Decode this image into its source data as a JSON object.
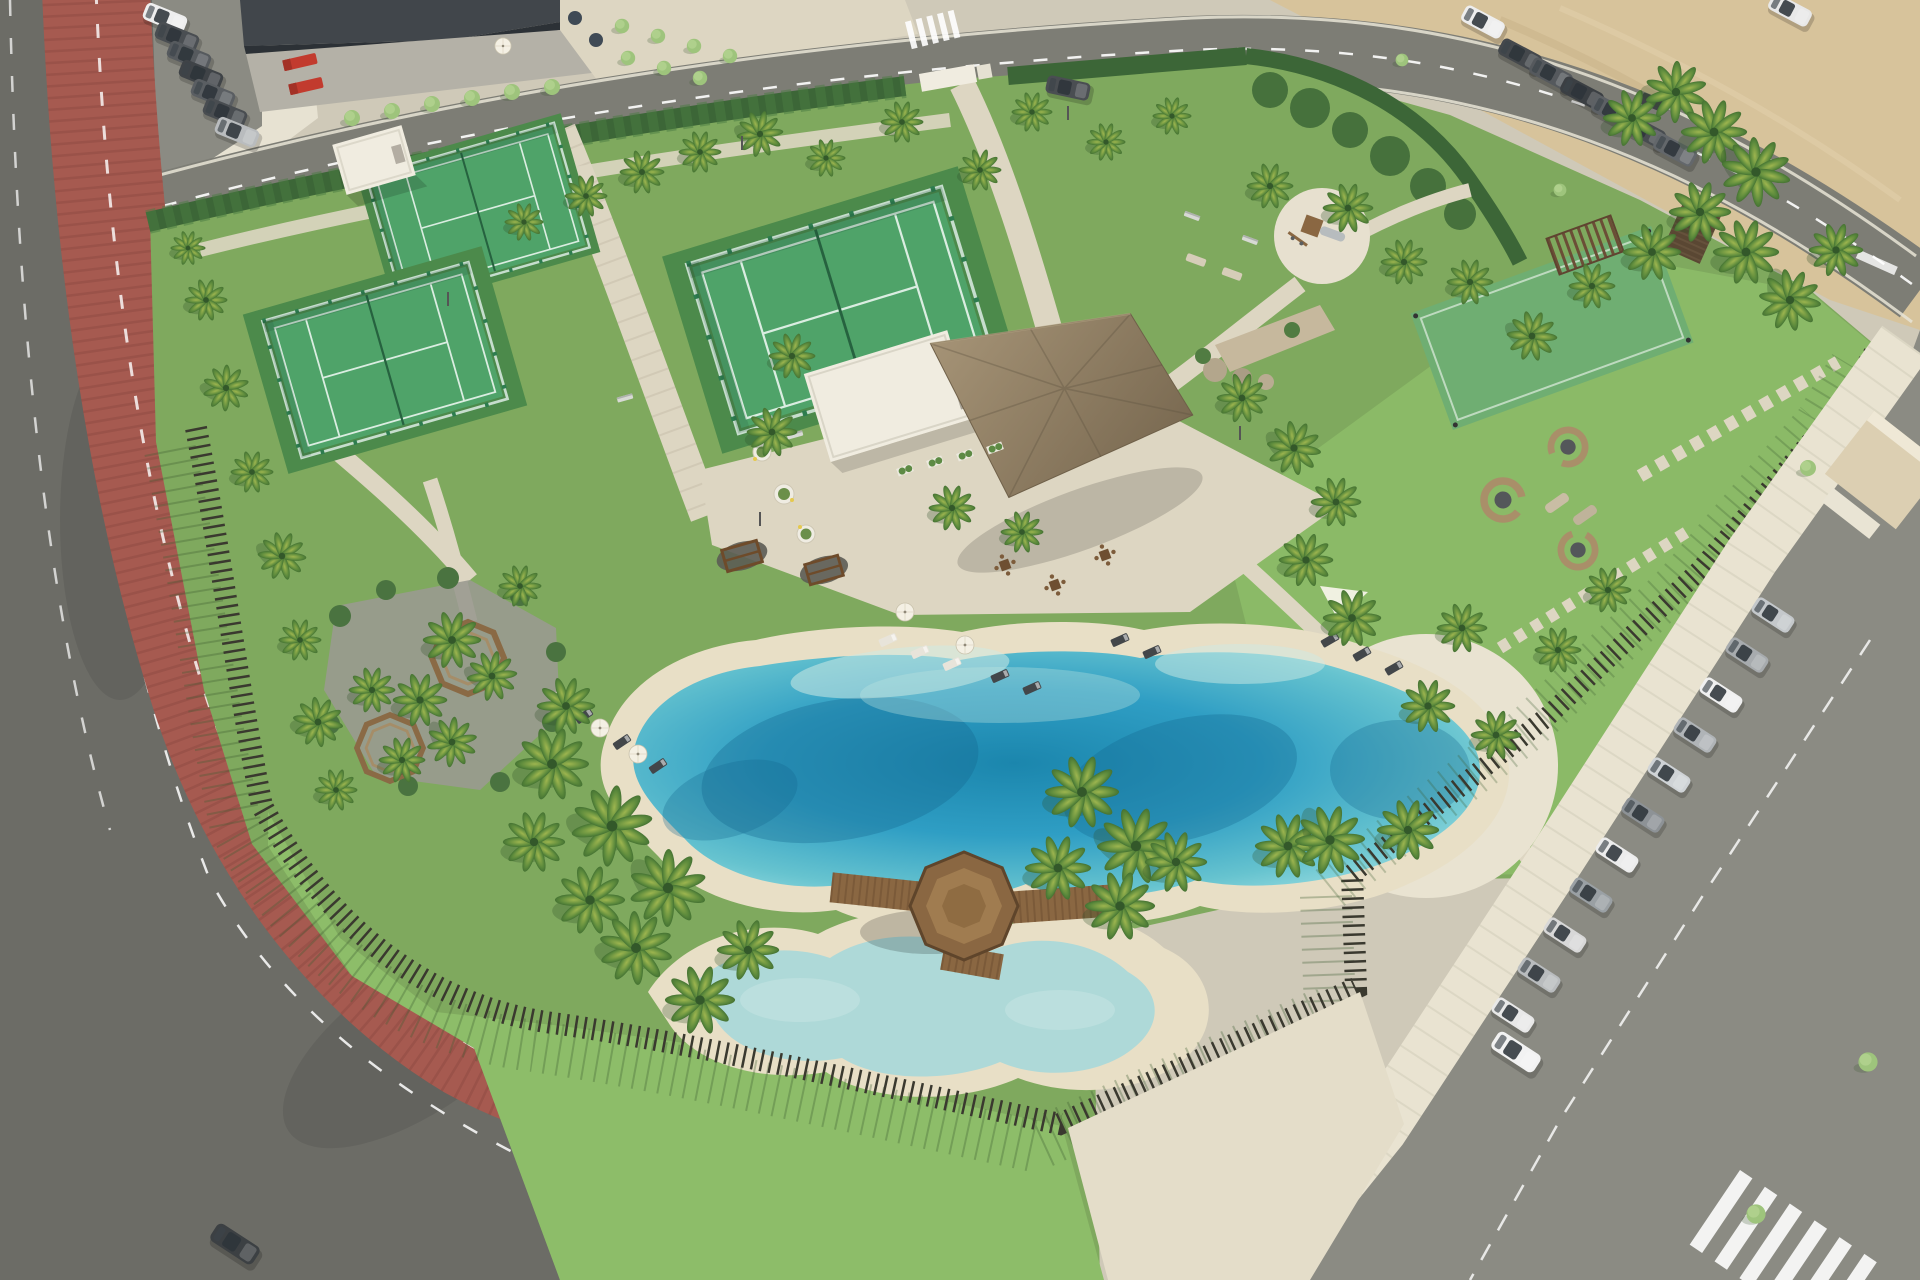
{
  "scene": {
    "description": "Aerial render of a coastal residents' amenity park: lagoon-style pool with sandy beach, kids pool, octagonal timber gazebo bridge, thatched palapa pavilion with white pool house, three padel courts, playground, mini turf pitch, rattan seating pods, red bike path and perimeter streets with parking",
    "lighting": "sunny day, shadows cast to the lower-left",
    "visible_text": ""
  },
  "palette": {
    "page_bg": "#cfc9b8",
    "paving": "#ddd6c2",
    "paving_bright": "#e9e3d1",
    "plaza": "#e4ddc9",
    "sand_beach": "#e8dfc6",
    "sand_lot": "#d7c39b",
    "asphalt": "#6c6c66",
    "asphalt_light": "#8b8b83",
    "road_top": "#7d7d75",
    "red_path": "#a65a50",
    "red_path_dark": "#8e4a42",
    "grass": "#7fa95e",
    "lawn": "#8dbd69",
    "turf": "#4c8a4b",
    "hedge": "#3c6637",
    "court_green": "#4fa369",
    "court_wall": "#7cc193",
    "mini_court": "#6fae72",
    "water_deep": "#14688f",
    "water_mid": "#2f9ec4",
    "water_light": "#8fd6dc",
    "kids_pool_water": "#aed9d8",
    "channel_water": "#9fcfd4",
    "thatch": "#8c7c63",
    "wood": "#8a6742",
    "wood_dark": "#6e4f31",
    "stone": "#c6b89d",
    "boulder": "#b3a68c",
    "fence": "#3a392f",
    "building_dark": "#41464b",
    "building_glass": "#2c3136",
    "building_white": "#f0ece0",
    "truck_red": "#c23b2e",
    "car_dark": "#4a4e52",
    "car_white": "#ececec",
    "car_silver": "#b9bcbe",
    "shadow_green": "#3e5c33"
  },
  "features": {
    "streets": {
      "lane_marking": "white-dashed",
      "bike_path": "terracotta-red with white dashed centerline",
      "crosswalks": 2
    },
    "padel_courts": {
      "count": 3,
      "surface_color": "#4fa369"
    },
    "mini_pitch": {
      "count": 1
    },
    "playground": {
      "has_slide": true
    },
    "pavilion": {
      "roof": "thatched-palapa",
      "attached_white_pool_house": true
    },
    "pools": {
      "lagoon": 1,
      "kids_pool": 1,
      "wooden_gazebo_bridge": 1
    },
    "seating_pods": {
      "count": 3
    },
    "octagonal_tree_benches": {
      "count": 2
    },
    "swing_frames": {
      "count": 2
    },
    "sun_loungers": {
      "count": 17
    },
    "parasols": {
      "count": 7,
      "shade_sails": 1
    },
    "boundary": {
      "hedge": true,
      "rustic_post_fence": true
    },
    "parking": {
      "right_row_cars": 12,
      "top_left_row_cars": 7,
      "top_right_row_cars": 8,
      "moving_cars": 2,
      "fire_trucks": 2
    },
    "vacant_sandy_lot": true,
    "palm_trees_approx": 66
  }
}
